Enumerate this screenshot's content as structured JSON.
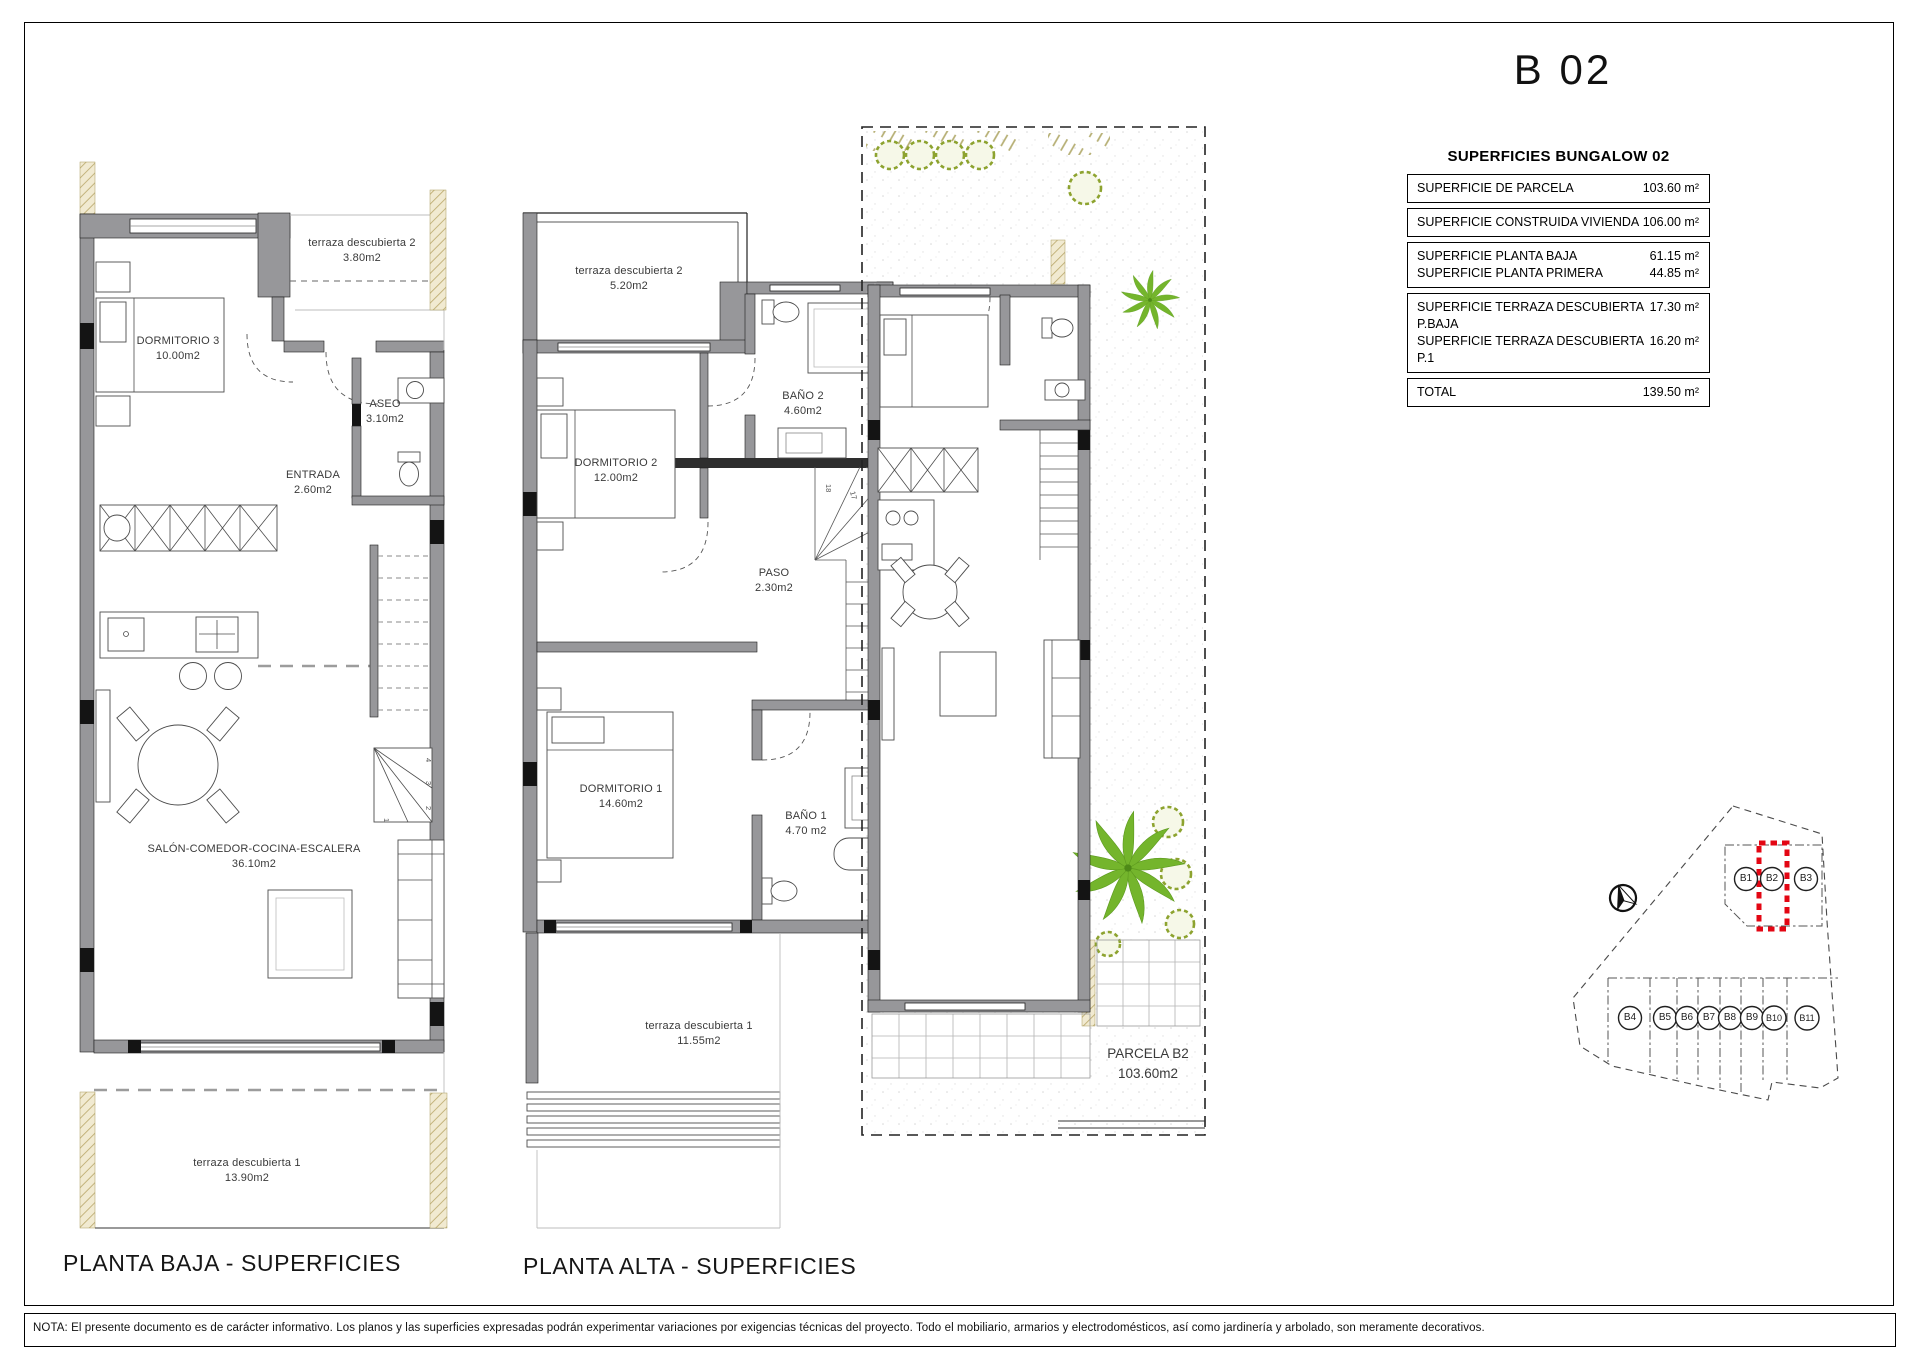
{
  "title": "B 02",
  "table": {
    "heading": "SUPERFICIES BUNGALOW 02",
    "groups": [
      {
        "rows": [
          {
            "label": "SUPERFICIE DE PARCELA",
            "value": "103.60 m²"
          }
        ]
      },
      {
        "rows": [
          {
            "label": "SUPERFICIE CONSTRUIDA VIVIENDA",
            "value": "106.00 m²"
          }
        ]
      },
      {
        "rows": [
          {
            "label": "SUPERFICIE PLANTA BAJA",
            "value": "61.15 m²"
          },
          {
            "label": "SUPERFICIE PLANTA PRIMERA",
            "value": "44.85 m²"
          }
        ]
      },
      {
        "rows": [
          {
            "label": "SUPERFICIE TERRAZA DESCUBIERTA P.BAJA",
            "value": "17.30 m²"
          },
          {
            "label": "SUPERFICIE TERRAZA DESCUBIERTA P.1",
            "value": "16.20 m²"
          }
        ]
      },
      {
        "rows": [
          {
            "label": "TOTAL",
            "value": "139.50 m²"
          }
        ]
      }
    ]
  },
  "plans": {
    "baja": {
      "caption": "PLANTA BAJA - SUPERFICIES",
      "rooms": {
        "dormitorio3": {
          "name": "DORMITORIO 3",
          "area": "10.00m2"
        },
        "aseo": {
          "name": "ASEO",
          "area": "3.10m2"
        },
        "entrada": {
          "name": "ENTRADA",
          "area": "2.60m2"
        },
        "salon": {
          "name": "SALÓN-COMEDOR-COCINA-ESCALERA",
          "area": "36.10m2"
        },
        "terraza2": {
          "name": "terraza descubierta 2",
          "area": "3.80m2"
        },
        "terraza1": {
          "name": "terraza descubierta 1",
          "area": "13.90m2"
        }
      },
      "stair_numbers": {
        "n1": "1",
        "n2": "2",
        "n3": "3",
        "n4": "4"
      }
    },
    "alta": {
      "caption": "PLANTA ALTA - SUPERFICIES",
      "rooms": {
        "terraza2": {
          "name": "terraza descubierta 2",
          "area": "5.20m2"
        },
        "dormitorio2": {
          "name": "DORMITORIO 2",
          "area": "12.00m2"
        },
        "bano2": {
          "name": "BAÑO 2",
          "area": "4.60m2"
        },
        "paso": {
          "name": "PASO",
          "area": "2.30m2"
        },
        "dormitorio1": {
          "name": "DORMITORIO 1",
          "area": "14.60m2"
        },
        "bano1": {
          "name": "BAÑO 1",
          "area": "4.70 m2"
        },
        "terraza1": {
          "name": "terraza descubierta 1",
          "area": "11.55m2"
        }
      },
      "stair_numbers": {
        "n10": "10",
        "n11": "11",
        "n12": "12",
        "n13": "13",
        "n14": "14",
        "n15": "15",
        "n16": "16",
        "n17": "17",
        "n18": "18"
      }
    },
    "parcela": {
      "name": "PARCELA B2",
      "area": "103.60m2"
    }
  },
  "site_plan": {
    "units": {
      "b1": "B1",
      "b2": "B2",
      "b3": "B3",
      "b4": "B4",
      "b5": "B5",
      "b6": "B6",
      "b7": "B7",
      "b8": "B8",
      "b9": "B9",
      "b10": "B10",
      "b11": "B11"
    },
    "highlighted_unit": "B2",
    "highlight_color": "#e30613"
  },
  "note": "NOTA:  El presente documento es de carácter informativo.  Los planos y las superficies expresadas podrán experimentar variaciones por exigencias técnicas del proyecto.  Todo el mobiliario, armarios y electrodomésticos, así como jardinería y arbolado, son meramente decorativos."
}
